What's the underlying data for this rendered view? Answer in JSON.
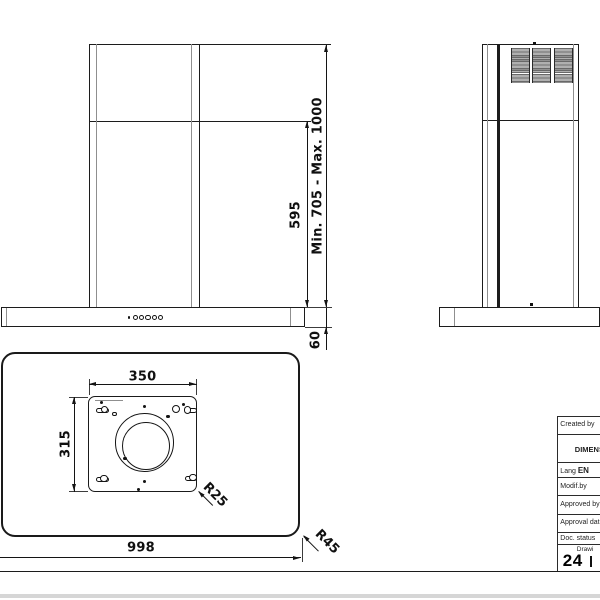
{
  "meta": {
    "description": "Technical dimension drawing of wall-mounted cooker hood",
    "line_color": "#1c1c1c",
    "background": "#ffffff"
  },
  "front_view": {
    "chimney_height": "595",
    "mount_height_range": "Min. 705 - Max. 1000",
    "body_height": "60"
  },
  "top_view": {
    "mount_plate_width": "350",
    "mount_plate_depth": "315",
    "plate_corner_radius": "R25",
    "body_corner_radius": "R45",
    "body_width": "998"
  },
  "title_block": {
    "created_by_label": "Created by",
    "doc_title": "DIMENSIONS",
    "lang_label": "Lang",
    "lang_value": "EN",
    "modif_by_label": "Modif.by",
    "approved_label": "Approved by",
    "approval_label": "Approval date",
    "doc_status_label": "Doc. status",
    "draw_label": "Drawi",
    "drawing_number": "24"
  }
}
